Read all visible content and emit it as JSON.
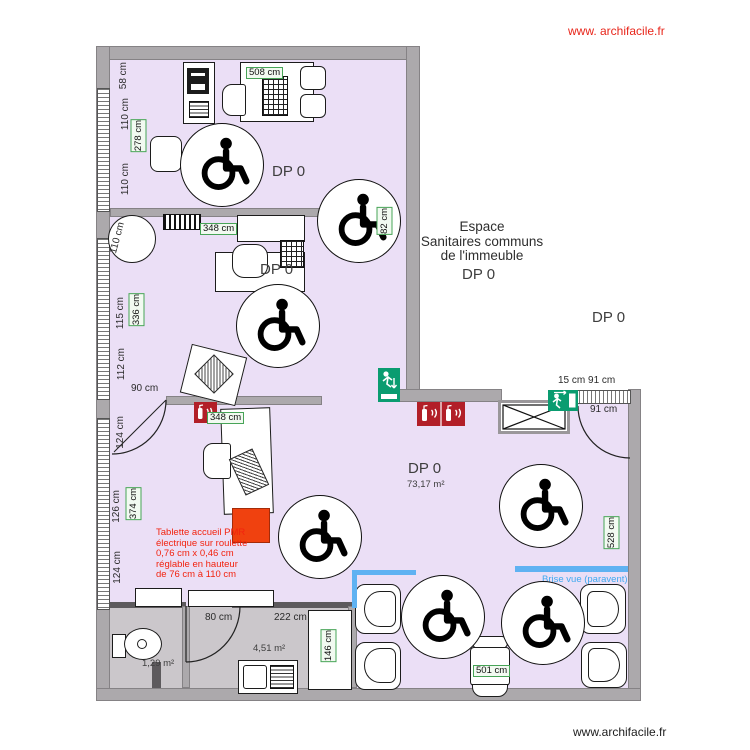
{
  "watermarks": {
    "top": "www. archifacile.fr",
    "bottom": "www.archifacile.fr"
  },
  "outside": {
    "line1": "Espace",
    "line2": "Sanitaires communs",
    "line3": "de l'immeuble",
    "dp1": "DP 0",
    "dp2": "DP 0"
  },
  "rooms": {
    "office_top": {
      "name": "DP 0"
    },
    "office_mid": {
      "name": "DP 0"
    },
    "main": {
      "name": "DP 0",
      "area": "73,17 m²"
    },
    "wc": {
      "area": "1,29 m²"
    },
    "kitchen": {
      "area": "4,51 m²"
    }
  },
  "dims": {
    "left_58": "58 cm",
    "left_110a": "110 cm",
    "left_278": "278 cm",
    "left_110b": "110 cm",
    "top_508": "508 cm",
    "r1_82": "82 cm",
    "mid_348": "348 cm",
    "mid_110": "110 cm",
    "mid_115": "115 cm",
    "mid_336": "336 cm",
    "mid_112": "112 cm",
    "mid_90": "90 cm",
    "low_124a": "124 cm",
    "low_126": "126 cm",
    "low_374": "374 cm",
    "low_124b": "124 cm",
    "recept_348": "348 cm",
    "tr_pair": "15 cm 91 cm",
    "tr_91": "91 cm",
    "right_528": "528 cm",
    "k_80": "80 cm",
    "k_222": "222 cm",
    "k_146": "146 cm",
    "t_501": "501 cm"
  },
  "ann": {
    "tablette": [
      "Tablette accueil PMR",
      "électrique sur roulette",
      "0,76 cm x 0,46 cm",
      "réglable en hauteur",
      "de 76 cm à 110 cm"
    ],
    "brise": "Brise vue (paravent)"
  },
  "icons": {
    "wheelchair": "wheelchair-accessibility-symbol",
    "exit": "emergency-exit-sign",
    "extinguisher": "fire-extinguisher-sign"
  },
  "colors": {
    "room_fill": "#ebdff6",
    "wall_gray": "#aca9ac",
    "service_floor": "#cbc7cb",
    "dim_green": "#47a457",
    "exit_green": "#0a9c70",
    "extinguisher_red": "#b21f28",
    "highlight_orange": "#f0410f",
    "annotation_red": "#f2230f",
    "paravent_blue": "#5fb2f2",
    "watermark_red": "#e8251a"
  }
}
